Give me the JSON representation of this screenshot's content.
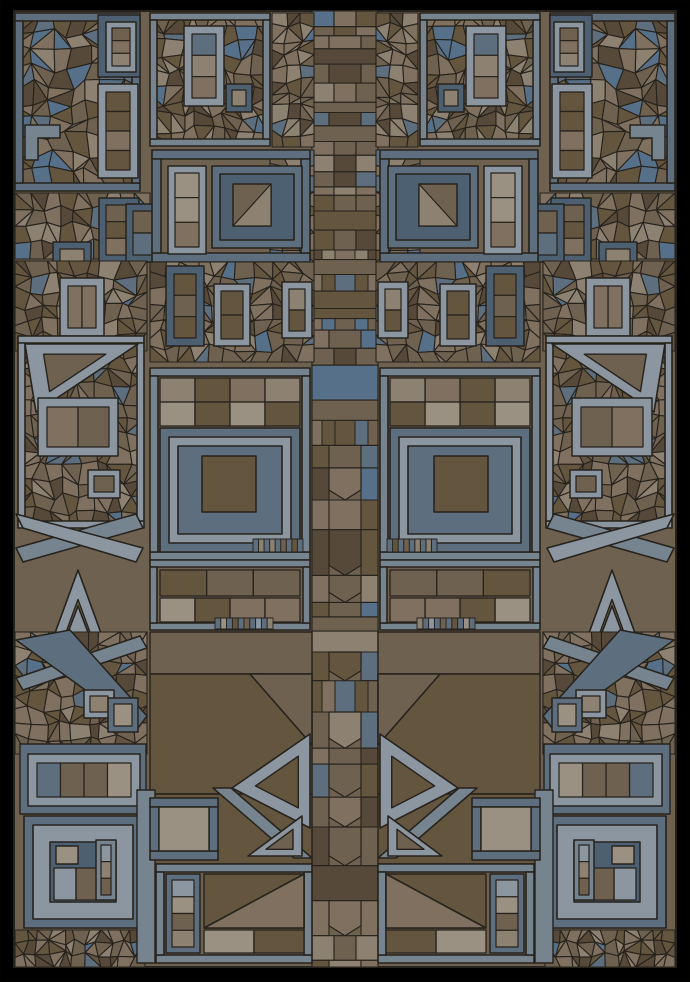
{
  "artwork": {
    "description": "Abstract geometric stained-glass mosaic, mirrored left-right, blue-gray spirals and rings over fractured brown cells on black",
    "canvas": {
      "width": 690,
      "height": 982,
      "background": "#000000"
    },
    "panel": {
      "x": 14,
      "y": 11,
      "width": 662,
      "height": 956,
      "base": "brown3"
    },
    "mirror_axis": 345,
    "stroke": {
      "color": "#26221c",
      "width": 1.4
    },
    "palette": {
      "blueDark": "#4d6072",
      "blueMid": "#5d6f7e",
      "blueSoft": "#76848f",
      "blueLight": "#8b96a1",
      "blueAccent": "#567089",
      "brown1": "#57493a",
      "brown2": "#64553f",
      "brown3": "#6f6150",
      "brown4": "#7f7060",
      "taupe": "#8d8172",
      "taupeLight": "#9a9183"
    },
    "shatter_colors": [
      "brown1",
      "brown2",
      "brown2",
      "brown3",
      "brown3",
      "brown4",
      "brown4",
      "taupe"
    ],
    "cell_colors": [
      "brown2",
      "brown3",
      "brown4",
      "taupe",
      "taupeLight"
    ],
    "spine": {
      "x": 312,
      "y": 11,
      "width": 66,
      "height": 956,
      "seed": 40
    },
    "motifs": [
      {
        "t": "shatter",
        "r": [
          17,
          15,
          121,
          174
        ],
        "s": 17,
        "seed": 1
      },
      {
        "t": "frame",
        "r": [
          15,
          13,
          125,
          178
        ],
        "th": 8,
        "c": "blueMid"
      },
      {
        "t": "rect",
        "r": [
          98,
          15,
          42,
          62
        ],
        "c": "blueDark"
      },
      {
        "t": "ring",
        "r": [
          106,
          22,
          30,
          50
        ],
        "th": 6,
        "c": "blueLight",
        "cells": 3,
        "dir": "v",
        "seed": 2
      },
      {
        "t": "ring",
        "r": [
          98,
          84,
          40,
          94
        ],
        "th": 8,
        "c": "blueLight",
        "cells": 4,
        "dir": "v",
        "seed": 3
      },
      {
        "t": "poly",
        "p": [
          [
            25,
            125
          ],
          [
            60,
            125
          ],
          [
            60,
            138
          ],
          [
            38,
            138
          ],
          [
            38,
            160
          ],
          [
            25,
            160
          ]
        ],
        "c": "blueSoft"
      },
      {
        "t": "shatter",
        "r": [
          15,
          193,
          135,
          66
        ],
        "s": 15,
        "seed": 11
      },
      {
        "t": "ring",
        "r": [
          99,
          198,
          40,
          64
        ],
        "th": 7,
        "c": "blueDark",
        "cells": 3,
        "dir": "v",
        "seed": 4
      },
      {
        "t": "ring",
        "r": [
          126,
          204,
          34,
          58
        ],
        "th": 7,
        "c": "blueDark",
        "cells": 2,
        "dir": "v",
        "seed": 13
      },
      {
        "t": "ring",
        "r": [
          53,
          242,
          38,
          58
        ],
        "th": 7,
        "c": "blueDark",
        "cells": 2,
        "dir": "v",
        "seed": 5
      },
      {
        "t": "shatter",
        "r": [
          152,
          15,
          116,
          129
        ],
        "s": 15,
        "seed": 6
      },
      {
        "t": "frame",
        "r": [
          150,
          13,
          120,
          133
        ],
        "th": 7,
        "c": "blueSoft"
      },
      {
        "t": "ring",
        "r": [
          184,
          26,
          40,
          80
        ],
        "th": 8,
        "c": "blueLight",
        "cells": 3,
        "dir": "v",
        "seed": 7
      },
      {
        "t": "ring",
        "r": [
          226,
          84,
          26,
          28
        ],
        "th": 6,
        "c": "blueDark",
        "cells": 1,
        "dir": "v",
        "seed": 8
      },
      {
        "t": "shatter",
        "r": [
          272,
          13,
          42,
          134
        ],
        "s": 13,
        "seed": 9
      },
      {
        "t": "shatter",
        "r": [
          270,
          150,
          44,
          112
        ],
        "s": 14,
        "seed": 14
      },
      {
        "t": "frame",
        "r": [
          152,
          150,
          158,
          112
        ],
        "th": 9,
        "c": "blueMid"
      },
      {
        "t": "ring",
        "r": [
          168,
          166,
          38,
          88
        ],
        "th": 7,
        "c": "blueLight",
        "cells": 3,
        "dir": "v",
        "seed": 10
      },
      {
        "t": "spiral",
        "r": [
          212,
          166,
          90,
          82
        ],
        "th": 8,
        "c1": "blueMid",
        "c2": "blueDark",
        "center": [
          233,
          184,
          38,
          42
        ],
        "cc": "brown3",
        "diag": true,
        "seed": 44
      },
      {
        "t": "shatter",
        "r": [
          15,
          261,
          132,
          90
        ],
        "s": 15,
        "seed": 12
      },
      {
        "t": "ring",
        "r": [
          60,
          278,
          44,
          58
        ],
        "th": 8,
        "c": "blueLight",
        "cells": 2,
        "dir": "h",
        "seed": 15
      },
      {
        "t": "shatter",
        "r": [
          150,
          262,
          164,
          100
        ],
        "s": 15,
        "seed": 19
      },
      {
        "t": "ring",
        "r": [
          166,
          266,
          38,
          80
        ],
        "th": 8,
        "c": "blueDark",
        "cells": 3,
        "dir": "v",
        "seed": 16
      },
      {
        "t": "ring",
        "r": [
          214,
          284,
          36,
          62
        ],
        "th": 7,
        "c": "blueLight",
        "cells": 2,
        "dir": "v",
        "seed": 17
      },
      {
        "t": "ring",
        "r": [
          282,
          282,
          30,
          56
        ],
        "th": 7,
        "c": "blueLight",
        "cells": 2,
        "dir": "v",
        "seed": 18
      },
      {
        "t": "shatter",
        "r": [
          20,
          340,
          122,
          186
        ],
        "s": 16,
        "seed": 20
      },
      {
        "t": "frame",
        "r": [
          18,
          336,
          126,
          192
        ],
        "th": 7,
        "c": "blueLight"
      },
      {
        "t": "tri",
        "p": [
          [
            25,
            344
          ],
          [
            138,
            344
          ],
          [
            36,
            412
          ]
        ],
        "c": "blueLight",
        "inner": "brown3",
        "f": 0.55
      },
      {
        "t": "ring",
        "r": [
          38,
          398,
          80,
          58
        ],
        "th": 9,
        "c": "blueLight",
        "cells": 2,
        "dir": "h",
        "seed": 21
      },
      {
        "t": "ring",
        "r": [
          88,
          470,
          32,
          28
        ],
        "th": 6,
        "c": "blueLight",
        "cells": 1,
        "dir": "v",
        "seed": 22
      },
      {
        "t": "poly",
        "p": [
          [
            16,
            548
          ],
          [
            136,
            514
          ],
          [
            143,
            528
          ],
          [
            23,
            562
          ]
        ],
        "c": "blueSoft"
      },
      {
        "t": "poly",
        "p": [
          [
            16,
            514
          ],
          [
            143,
            548
          ],
          [
            136,
            562
          ],
          [
            23,
            528
          ]
        ],
        "c": "blueLight"
      },
      {
        "t": "tri",
        "p": [
          [
            78,
            570
          ],
          [
            140,
            740
          ],
          [
            16,
            740
          ]
        ],
        "c": "blueLight",
        "inner": "brown3",
        "f": 0.74
      },
      {
        "t": "tri",
        "p": [
          [
            78,
            606
          ],
          [
            122,
            722
          ],
          [
            34,
            722
          ]
        ],
        "c": "blueLight",
        "inner": "brown2",
        "f": 0.58
      },
      {
        "t": "frame",
        "r": [
          150,
          368,
          160,
          192
        ],
        "th": 8,
        "c": "blueSoft"
      },
      {
        "t": "cells",
        "r": [
          160,
          378,
          140,
          48
        ],
        "rows": 2,
        "cols": 4,
        "seed": 26
      },
      {
        "t": "spiral",
        "r": [
          160,
          428,
          140,
          124
        ],
        "th": 9,
        "c1": "blueMid",
        "c2": "blueLight",
        "center": [
          202,
          456,
          54,
          56
        ],
        "cc": "brown2",
        "seed": 27
      },
      {
        "t": "ticks",
        "r": [
          253,
          539,
          50,
          13
        ],
        "n": 9,
        "seed": 28
      },
      {
        "t": "frame",
        "r": [
          150,
          560,
          160,
          70
        ],
        "th": 7,
        "c": "blueSoft"
      },
      {
        "t": "cells",
        "r": [
          160,
          570,
          140,
          26
        ],
        "rows": 1,
        "cols": 3,
        "seed": 29
      },
      {
        "t": "cells",
        "r": [
          160,
          598,
          140,
          24
        ],
        "rows": 1,
        "cols": 4,
        "seed": 30
      },
      {
        "t": "ticks",
        "r": [
          215,
          618,
          58,
          11
        ],
        "n": 10,
        "seed": 31
      },
      {
        "t": "rect",
        "r": [
          150,
          632,
          162,
          42
        ],
        "c": "brown3"
      },
      {
        "t": "rect",
        "r": [
          150,
          674,
          162,
          120
        ],
        "c": "brown2"
      },
      {
        "t": "tri",
        "p": [
          [
            250,
            674
          ],
          [
            312,
            674
          ],
          [
            312,
            745
          ]
        ],
        "c": "brown3"
      },
      {
        "t": "rect",
        "r": [
          150,
          794,
          162,
          70
        ],
        "c": "brown2"
      },
      {
        "t": "shatter",
        "r": [
          15,
          632,
          132,
          122
        ],
        "s": 15,
        "seed": 32
      },
      {
        "t": "poly",
        "p": [
          [
            16,
            678
          ],
          [
            140,
            636
          ],
          [
            147,
            648
          ],
          [
            23,
            690
          ]
        ],
        "c": "blueSoft"
      },
      {
        "t": "poly",
        "p": [
          [
            16,
            640
          ],
          [
            70,
            630
          ],
          [
            147,
            716
          ],
          [
            138,
            728
          ]
        ],
        "c": "blueMid"
      },
      {
        "t": "ring",
        "r": [
          84,
          690,
          30,
          28
        ],
        "th": 6,
        "c": "blueLight",
        "cells": 1,
        "dir": "v",
        "seed": 33
      },
      {
        "t": "ring",
        "r": [
          108,
          698,
          30,
          34
        ],
        "th": 6,
        "c": "blueMid",
        "cells": 1,
        "dir": "v",
        "seed": 34
      },
      {
        "t": "rect",
        "r": [
          20,
          744,
          126,
          70
        ],
        "c": "blueMid"
      },
      {
        "t": "ring",
        "r": [
          28,
          754,
          112,
          52
        ],
        "th": 9,
        "c": "blueLight",
        "cells": 4,
        "dir": "h",
        "seed": 23
      },
      {
        "t": "spiral",
        "r": [
          24,
          816,
          118,
          112
        ],
        "th": 9,
        "c1": "blueMid",
        "c2": "blueLight",
        "center": [
          50,
          842,
          66,
          60
        ],
        "cc": "blueDark",
        "seed": 24
      },
      {
        "t": "rect",
        "r": [
          56,
          846,
          22,
          18
        ],
        "c": "taupeLight"
      },
      {
        "t": "cells",
        "r": [
          54,
          868,
          44,
          32
        ],
        "rows": 1,
        "cols": 2,
        "seed": 45
      },
      {
        "t": "ring",
        "r": [
          96,
          840,
          20,
          60
        ],
        "th": 5,
        "c": "blueSoft",
        "cells": 3,
        "dir": "v",
        "seed": 46
      },
      {
        "t": "shatter",
        "r": [
          15,
          930,
          130,
          37
        ],
        "s": 12,
        "seed": 25
      },
      {
        "t": "tri",
        "p": [
          [
            232,
            788
          ],
          [
            310,
            734
          ],
          [
            310,
            828
          ]
        ],
        "c": "blueLight",
        "inner": "brown2",
        "f": 0.55
      },
      {
        "t": "poly",
        "p": [
          [
            213,
            788
          ],
          [
            231,
            788
          ],
          [
            312,
            858
          ],
          [
            294,
            858
          ]
        ],
        "c": "blueSoft"
      },
      {
        "t": "tri",
        "p": [
          [
            248,
            856
          ],
          [
            302,
            816
          ],
          [
            302,
            856
          ]
        ],
        "c": "blueLight",
        "inner": "brown3",
        "f": 0.5
      },
      {
        "t": "rect",
        "r": [
          137,
          790,
          18,
          173
        ],
        "c": "blueSoft"
      },
      {
        "t": "frame",
        "r": [
          150,
          798,
          68,
          62
        ],
        "th": 9,
        "c": "blueMid"
      },
      {
        "t": "rect",
        "r": [
          159,
          807,
          50,
          44
        ],
        "c": "taupeLight"
      },
      {
        "t": "frame",
        "r": [
          156,
          864,
          156,
          99
        ],
        "th": 8,
        "c": "blueSoft"
      },
      {
        "t": "ring",
        "r": [
          166,
          874,
          34,
          79
        ],
        "th": 6,
        "c": "blueMid",
        "cells": 4,
        "dir": "v",
        "seed": 35
      },
      {
        "t": "rect",
        "r": [
          204,
          874,
          100,
          54
        ],
        "c": "brown2"
      },
      {
        "t": "tri",
        "p": [
          [
            204,
            928
          ],
          [
            304,
            874
          ],
          [
            304,
            928
          ]
        ],
        "c": "brown4"
      },
      {
        "t": "cells",
        "r": [
          204,
          930,
          100,
          23
        ],
        "rows": 1,
        "cols": 2,
        "seed": 36
      }
    ]
  }
}
